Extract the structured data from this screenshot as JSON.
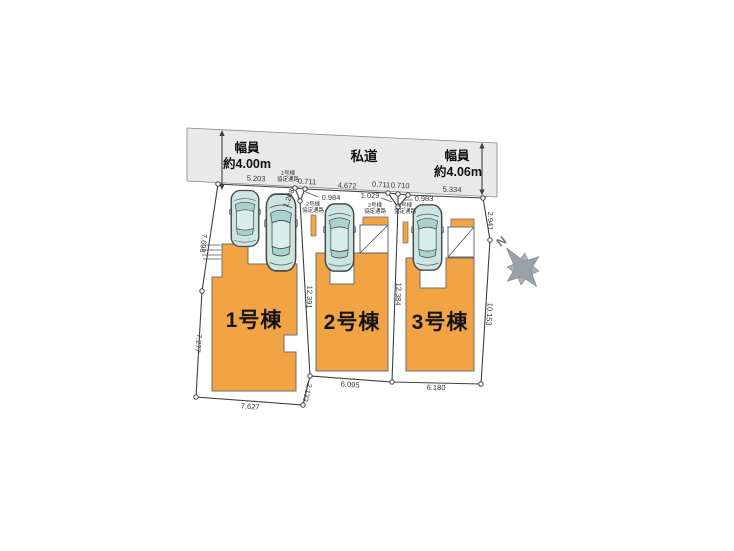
{
  "road": {
    "label": "私道",
    "width_left": {
      "l1": "幅員",
      "l2": "約4.00m"
    },
    "width_right": {
      "l1": "幅員",
      "l2": "約4.06m"
    }
  },
  "lots": {
    "lot1": {
      "label": "1号棟"
    },
    "lot2": {
      "label": "2号棟"
    },
    "lot3": {
      "label": "3号棟"
    }
  },
  "passages": {
    "p1": {
      "l1": "1号棟",
      "l2": "協定通路"
    },
    "p2a": {
      "l1": "2号棟",
      "l2": "協定通路"
    },
    "p2b": {
      "l1": "2号棟",
      "l2": "協定通路"
    },
    "p3": {
      "l1": "3号棟",
      "l2": "協定通路"
    }
  },
  "dims": {
    "top1": "5.203",
    "j1_top": "0.711",
    "j1_diag": "1.208",
    "j1_right": "0.984",
    "top2": "4.672",
    "j2_top_a": "0.711",
    "j2_top_b": "0.710",
    "j2_left": "1.029",
    "j2_right": "0.983",
    "top3": "5.334",
    "right_upper": "2.941",
    "right_lower": "10.153",
    "div12": "12.391",
    "div23": "12.384",
    "left_upper": "7.698",
    "left_lower": "7.277",
    "bottom1": "7.627",
    "mid_step": "2.133",
    "bottom2": "6.095",
    "bottom3": "6.180"
  },
  "compass": {
    "north": "N"
  },
  "colors": {
    "building": "#F2A444",
    "road_fill": "#E9E9E9",
    "car_body": "#CBE5E1",
    "car_glass": "#A8D2CC",
    "car_roof": "#D9EEEA"
  }
}
